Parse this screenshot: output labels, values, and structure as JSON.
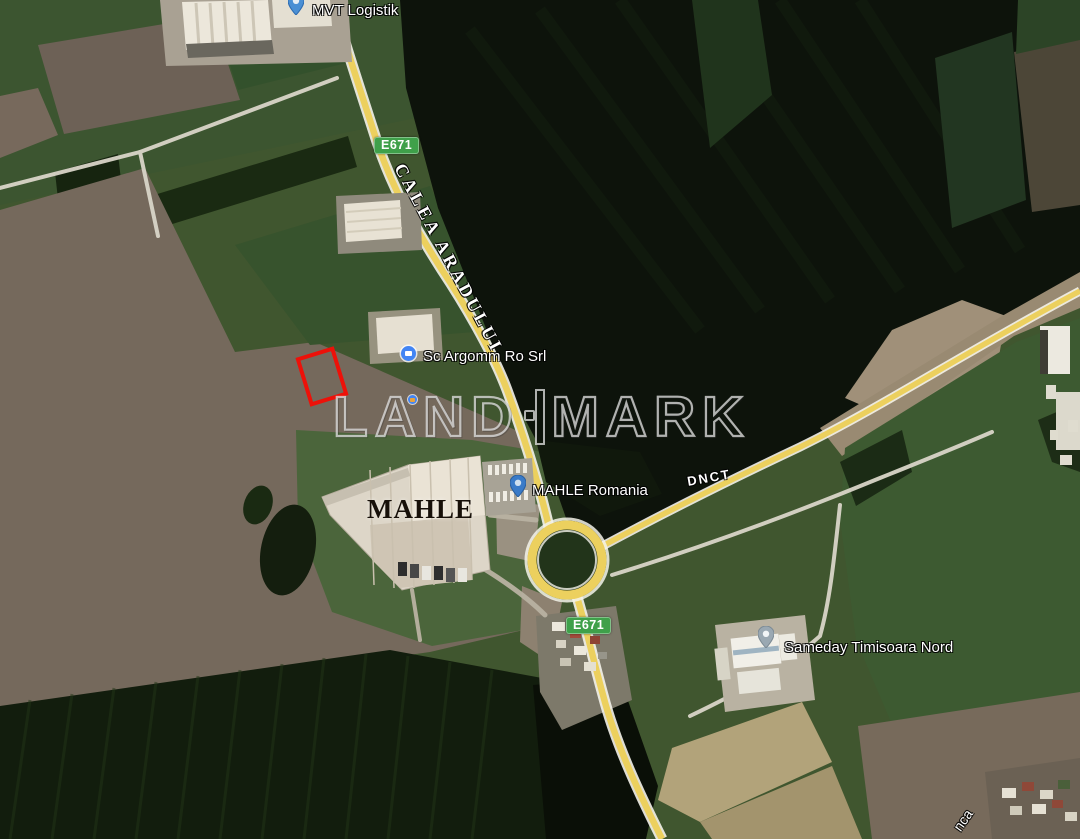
{
  "map": {
    "view": "satellite",
    "watermark": {
      "left": "LAND",
      "right": "MARK"
    },
    "road_badges": [
      {
        "label": "E671"
      },
      {
        "label": "E671"
      }
    ],
    "road_labels": [
      {
        "text": "CALEA ARADULUI"
      },
      {
        "text": "DNCT"
      },
      {
        "text": "nca"
      }
    ],
    "pois": [
      {
        "name": "MVT Logistik"
      },
      {
        "name": "Sc Argomm Ro Srl"
      },
      {
        "name": "MAHLE Romania"
      },
      {
        "name": "Sameday Timisoara Nord"
      }
    ],
    "site_labels": [
      {
        "text": "MAHLE"
      }
    ],
    "colors": {
      "highlight_red": "#ed1109",
      "badge_green": "#3fa04a",
      "road_yellow": "#ecd05e"
    }
  }
}
